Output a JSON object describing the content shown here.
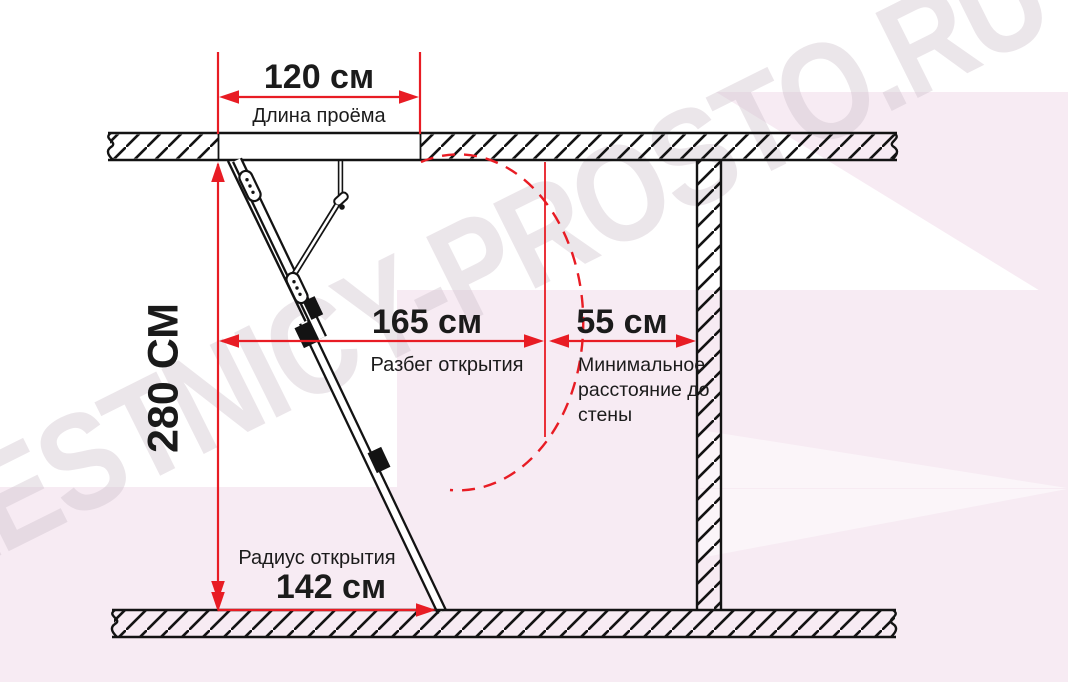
{
  "watermark": "LESTNICY-PROSTO.RU",
  "dimensions": {
    "opening_length": {
      "value": "120 см",
      "label": "Длина проёма"
    },
    "height": {
      "value": "280 СМ"
    },
    "opening_span": {
      "value": "165 см",
      "label": "Разбег открытия"
    },
    "wall_clearance": {
      "value": "55 см",
      "label": "Минимальное расстояние до стены"
    },
    "opening_radius": {
      "value": "142 см",
      "label": "Радиус открытия"
    }
  },
  "colors": {
    "dimension_red": "#e81c24",
    "diagram_black": "#131313",
    "background_pink": "#f7ebf3",
    "watermark_gray": "#cdbfca"
  }
}
